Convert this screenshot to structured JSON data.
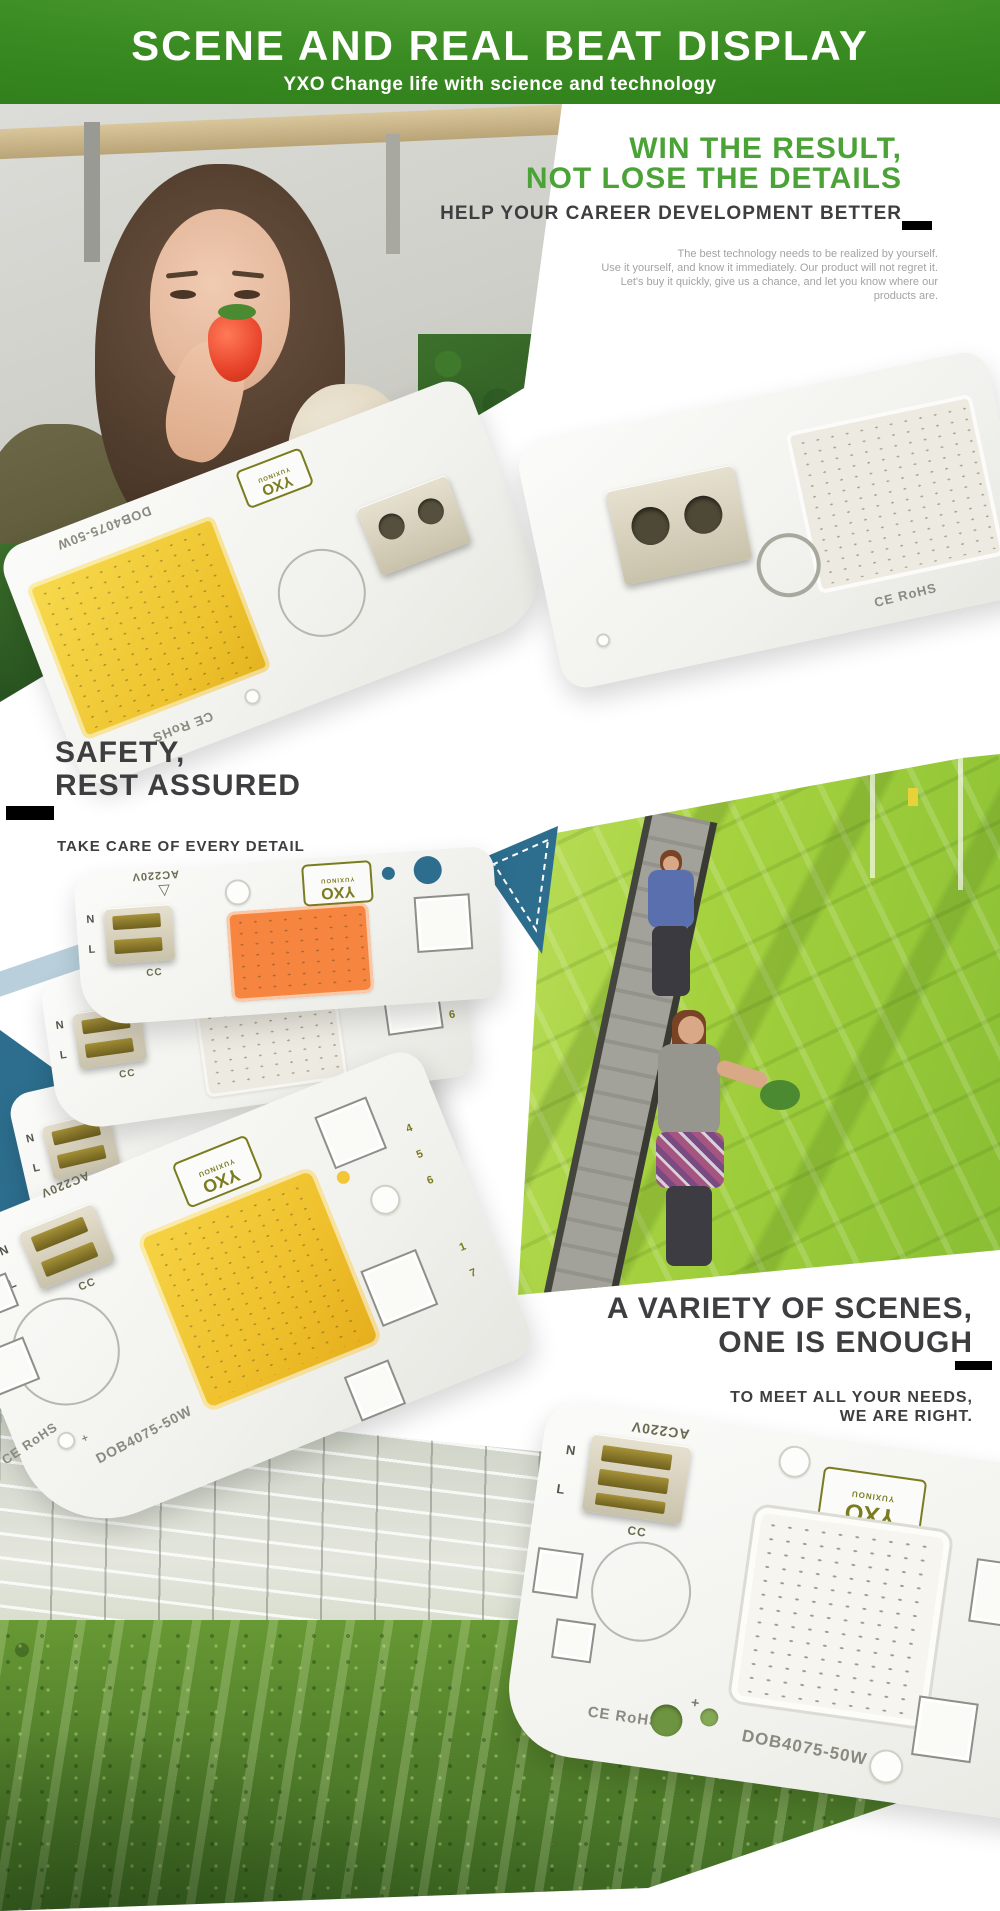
{
  "banner": {
    "title": "SCENE AND REAL BEAT DISPLAY",
    "subtitle": "YXO Change life with science and technology"
  },
  "hero": {
    "headline1": "WIN THE RESULT,",
    "headline2": "NOT LOSE THE DETAILS",
    "subheadline": "HELP YOUR CAREER DEVELOPMENT BETTER",
    "paragraph": [
      "The best technology needs to be realized by yourself.",
      "Use it yourself, and know it immediately. Our product will not regret it.",
      "Let's buy it quickly, give us a chance, and let you know where our",
      "products are."
    ]
  },
  "safety": {
    "headline1": "SAFETY,",
    "headline2": "REST ASSURED",
    "tagline": "TAKE CARE OF EVERY DETAIL"
  },
  "variety": {
    "headline1": "A VARIETY OF SCENES,",
    "headline2": "ONE IS ENOUGH",
    "tagline1": "TO MEET ALL YOUR NEEDS,",
    "tagline2": "WE ARE RIGHT."
  },
  "module": {
    "brand": "YXO",
    "brand_sub": "YUXINOU",
    "voltage": "AC220V",
    "label_n": "N",
    "label_l": "L",
    "label_cc": "CC",
    "cert": "CE RoHS",
    "model": "DOB4075-50W",
    "plus": "+",
    "pin_numbers_top": "4 5 6",
    "pin_numbers_bottom": "1 7",
    "triangle_mark": "▽"
  },
  "colors": {
    "banner_green": "#3a8b22",
    "accent_green": "#4ba338",
    "heading_dark": "#3e3e41",
    "teal": "#2d6e8e",
    "light_blue": "#b9d0dc",
    "cob_orange": "#f5853f",
    "cob_yellow": "#f2c637",
    "cob_warm_white": "#edebe1",
    "paragraph_gray": "#a3a3a3"
  }
}
